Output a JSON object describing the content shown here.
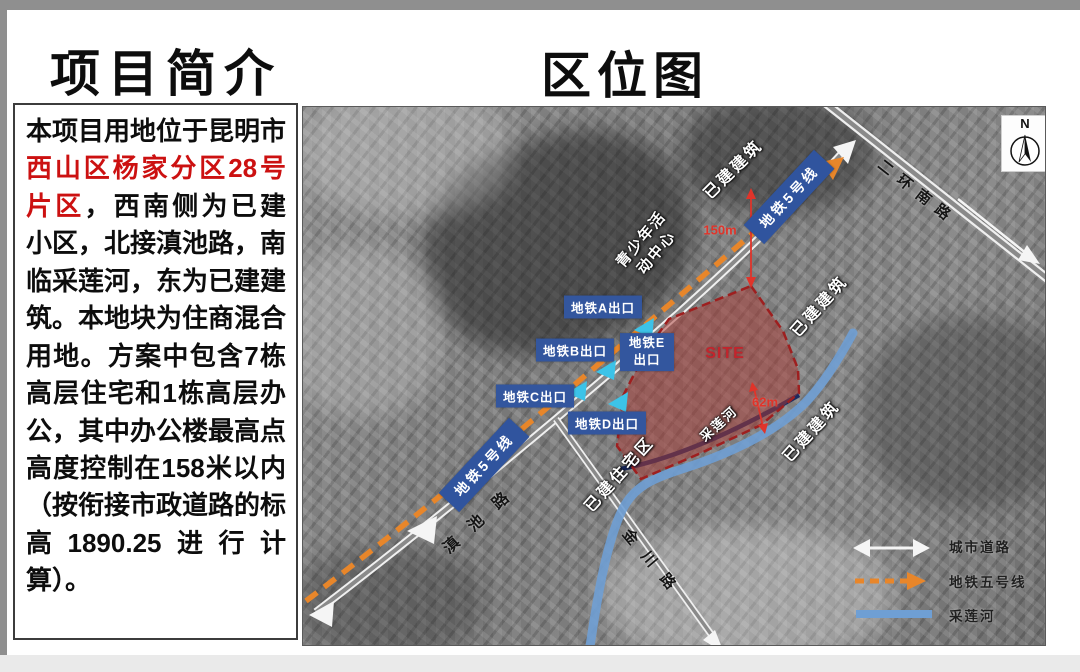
{
  "titles": {
    "left": "项目简介",
    "right": "区位图"
  },
  "description": {
    "pre": "本项目用地位于昆明市",
    "highlight": "西山区杨家分区28号片区",
    "post": "，西南侧为已建小区，北接滇池路，南临采莲河，东为已建建筑。本地块为住商混合用地。方案中包含7栋高层住宅和1栋高层办公，其中办公楼最高点高度控制在158米以内（按衔接市政道路的标高1890.25进行计算）。"
  },
  "map": {
    "compass": "N",
    "metro_banner": "地铁5号线",
    "roads": {
      "erhuannanlu": "二环南路",
      "dianchilu": "滇池路",
      "jinchuanlu": "金川路"
    },
    "exits": {
      "a": "地铁A出口",
      "b": "地铁B出口",
      "e": "地铁E出口",
      "c": "地铁C出口",
      "d": "地铁D出口"
    },
    "labels": {
      "built_top": "已建建筑",
      "built_right_upper": "已建建筑",
      "built_right_lower": "已建建筑",
      "residential": "已建住宅区",
      "youth_line1": "青少年活",
      "youth_line2": "动中心",
      "river": "采莲河",
      "site": "SITE"
    },
    "dimensions": {
      "north": "150m",
      "south": "62m"
    },
    "legend": {
      "road": "城市道路",
      "metro": "地铁五号线",
      "river": "采莲河"
    },
    "colors": {
      "metro_orange": "#e8862a",
      "banner_blue": "#30549e",
      "river_blue": "#6f9fd4",
      "site_fill": "#ac3a34",
      "site_border": "#9e1f1f",
      "dim_red": "#e0342a",
      "cyan_arrow": "#3cc3e8",
      "highlight_red": "#cc1111"
    }
  }
}
